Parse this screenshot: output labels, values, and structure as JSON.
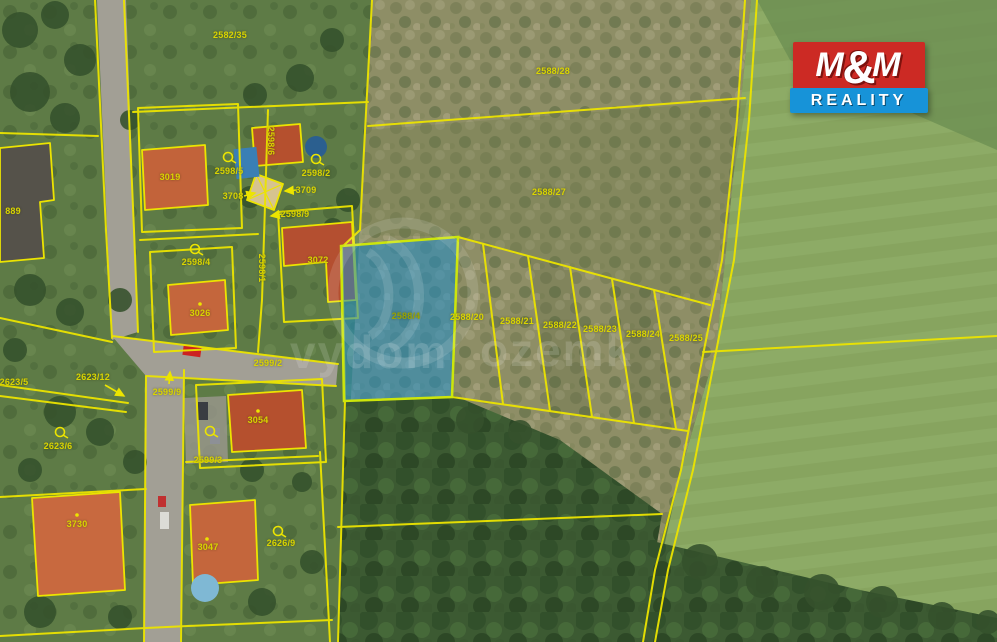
{
  "map": {
    "line_color": "#ece400",
    "label_color": "#d9d400",
    "highlighted_parcel": "2588/4",
    "highlight_fill": "#1e8cc8",
    "highlight_border": "#cde60a",
    "labels": [
      {
        "text": "2582/35",
        "x": 230,
        "y": 35
      },
      {
        "text": "2588/28",
        "x": 553,
        "y": 71
      },
      {
        "text": "2588/27",
        "x": 549,
        "y": 192
      },
      {
        "text": "2598/2",
        "x": 316,
        "y": 173,
        "marker": {
          "type": "circle",
          "x": 316,
          "y": 159
        }
      },
      {
        "text": "3019",
        "x": 170,
        "y": 177
      },
      {
        "text": "2598/5",
        "x": 229,
        "y": 171,
        "marker": {
          "type": "circle",
          "x": 228,
          "y": 157
        }
      },
      {
        "text": "2598/6",
        "x": 271,
        "y": 141,
        "rot": 90
      },
      {
        "text": "3709",
        "x": 306,
        "y": 190,
        "arrow": {
          "x1": 297,
          "y1": 190,
          "x2": 285,
          "y2": 191
        }
      },
      {
        "text": "3708",
        "x": 233,
        "y": 196,
        "arrow": {
          "x1": 244,
          "y1": 196,
          "x2": 255,
          "y2": 193
        }
      },
      {
        "text": "2598/9",
        "x": 295,
        "y": 214,
        "arrow": {
          "x1": 282,
          "y1": 214,
          "x2": 271,
          "y2": 216
        }
      },
      {
        "text": "2598/4",
        "x": 196,
        "y": 262,
        "marker": {
          "type": "circle",
          "x": 195,
          "y": 249
        }
      },
      {
        "text": "3072",
        "x": 318,
        "y": 260
      },
      {
        "text": "3026",
        "x": 200,
        "y": 313,
        "marker": {
          "type": "dot",
          "x": 200,
          "y": 304
        }
      },
      {
        "text": "2598/1",
        "x": 262,
        "y": 268,
        "rot": 90
      },
      {
        "text": "2599/2",
        "x": 268,
        "y": 363
      },
      {
        "text": "2623/12",
        "x": 93,
        "y": 377,
        "arrow": {
          "x1": 105,
          "y1": 385,
          "x2": 124,
          "y2": 396
        }
      },
      {
        "text": "2623/6",
        "x": 58,
        "y": 446,
        "marker": {
          "type": "circle",
          "x": 60,
          "y": 432
        }
      },
      {
        "text": "2623/5",
        "x": 14,
        "y": 382
      },
      {
        "text": "2599/9",
        "x": 167,
        "y": 392,
        "arrow": {
          "x1": 169,
          "y1": 384,
          "x2": 170,
          "y2": 372
        }
      },
      {
        "text": "2599/3",
        "x": 208,
        "y": 460,
        "marker": {
          "type": "circle",
          "x": 210,
          "y": 431
        }
      },
      {
        "text": "3054",
        "x": 258,
        "y": 420,
        "marker": {
          "type": "dot",
          "x": 258,
          "y": 411
        }
      },
      {
        "text": "3730",
        "x": 77,
        "y": 524,
        "marker": {
          "type": "dot",
          "x": 77,
          "y": 515
        }
      },
      {
        "text": "3047",
        "x": 208,
        "y": 547,
        "marker": {
          "type": "dot",
          "x": 207,
          "y": 539
        }
      },
      {
        "text": "2626/9",
        "x": 281,
        "y": 543,
        "marker": {
          "type": "circle",
          "x": 278,
          "y": 531
        }
      },
      {
        "text": "889",
        "x": 13,
        "y": 211
      },
      {
        "text": "2588/4",
        "x": 406,
        "y": 316,
        "color": "#98a300"
      },
      {
        "text": "2588/20",
        "x": 467,
        "y": 317
      },
      {
        "text": "2588/21",
        "x": 517,
        "y": 321
      },
      {
        "text": "2588/22",
        "x": 560,
        "y": 325
      },
      {
        "text": "2588/23",
        "x": 600,
        "y": 329
      },
      {
        "text": "2588/24",
        "x": 643,
        "y": 334
      },
      {
        "text": "2588/25",
        "x": 686,
        "y": 338
      }
    ]
  },
  "logo": {
    "m_left": "M",
    "amp": "&",
    "m_right": "M",
    "line2": "REALITY",
    "red": "#cc2a24",
    "blue": "#1793d8"
  },
  "watermark": {
    "fragments": [
      "vydom",
      "ozemk"
    ]
  }
}
